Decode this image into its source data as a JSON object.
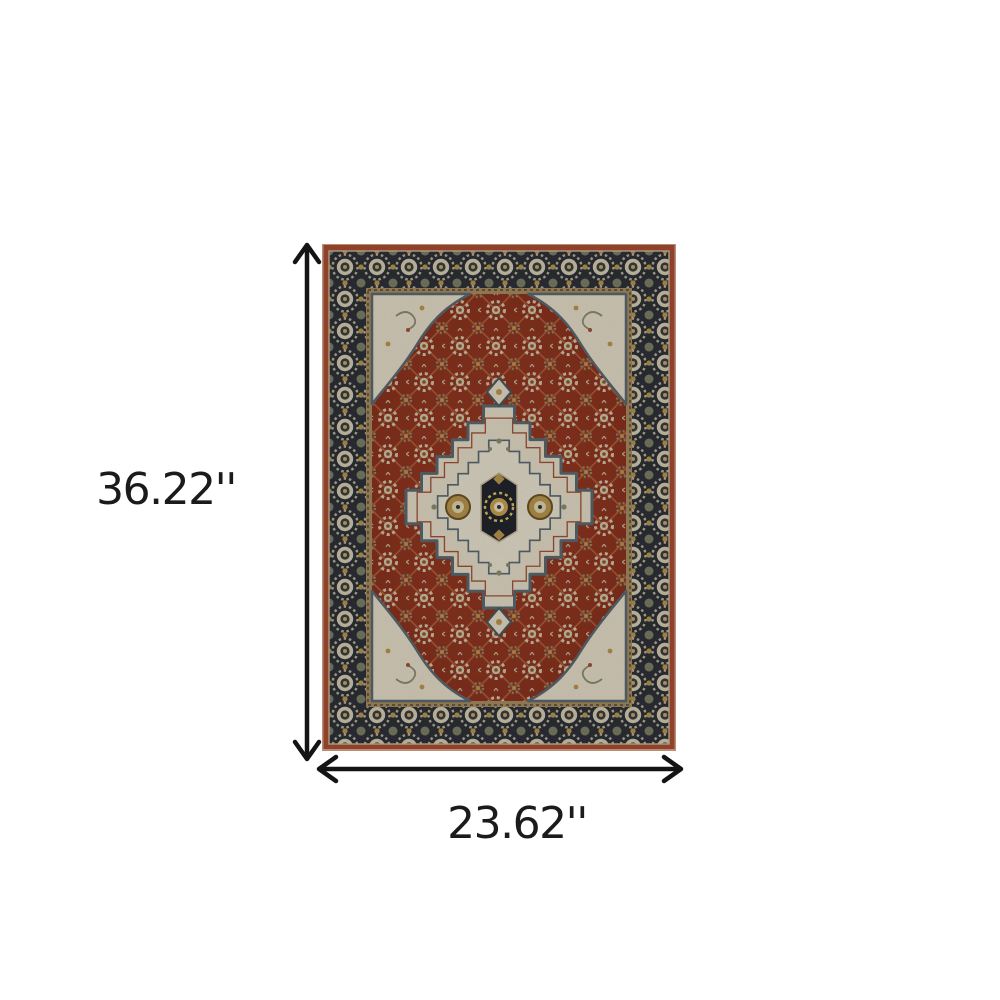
{
  "annotation": {
    "height_label": "36.22''",
    "width_label": "23.62''"
  },
  "graphics": {
    "rug": "oriental-medallion-area-rug-photo",
    "vertical_arrow": "double-headed-vertical-dimension-arrow",
    "horizontal_arrow": "double-headed-horizontal-dimension-arrow"
  },
  "colors": {
    "background": "#ffffff",
    "arrow": "#141414",
    "label_text": "#1b1b1b",
    "rug_edge_rust": "#ad4e33",
    "rug_fringe_peach": "#dfab8e",
    "rug_border_navy": "#2f323a",
    "rug_guard_tan": "#a98e63",
    "rug_field_red": "#8e3420",
    "rug_lattice_rust": "#b4613c",
    "rug_ivory": "#e7dfc9",
    "rug_rosette_ivory": "#d8cfb3",
    "rug_gold": "#bd9750",
    "rug_sage": "#8c9070",
    "rug_outline_blue": "#5c6b74"
  }
}
